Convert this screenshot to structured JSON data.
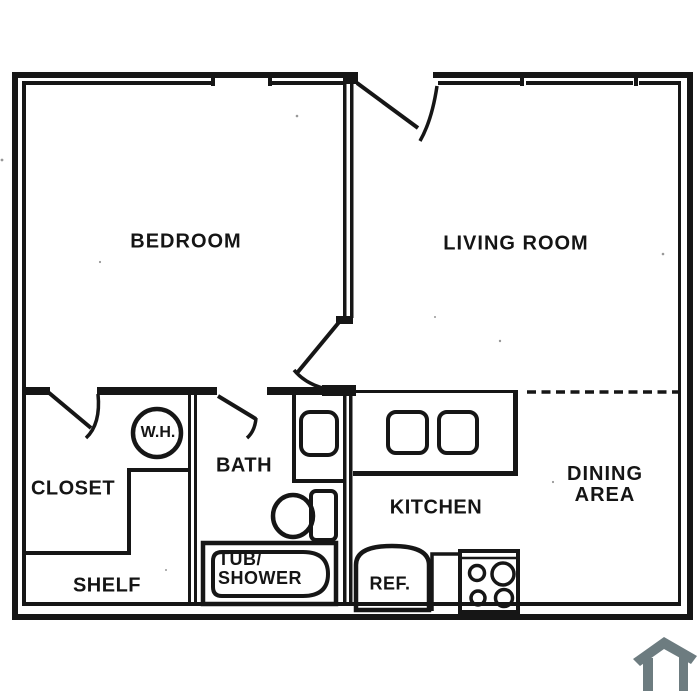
{
  "plan": {
    "title": "one-bedroom apartment floor plan",
    "rooms": {
      "bedroom": "BEDROOM",
      "living_room": "LIVING ROOM",
      "closet": "CLOSET",
      "shelf": "SHELF",
      "bath": "BATH",
      "kitchen": "KITCHEN",
      "dining_line1": "DINING",
      "dining_line2": "AREA"
    },
    "fixtures": {
      "water_heater": "W.H.",
      "refrigerator": "REF.",
      "tub_line1": "TUB/",
      "tub_line2": "SHOWER"
    },
    "colors": {
      "line": "#161616",
      "background": "#ffffff",
      "home_icon": "#6d7c80"
    }
  }
}
